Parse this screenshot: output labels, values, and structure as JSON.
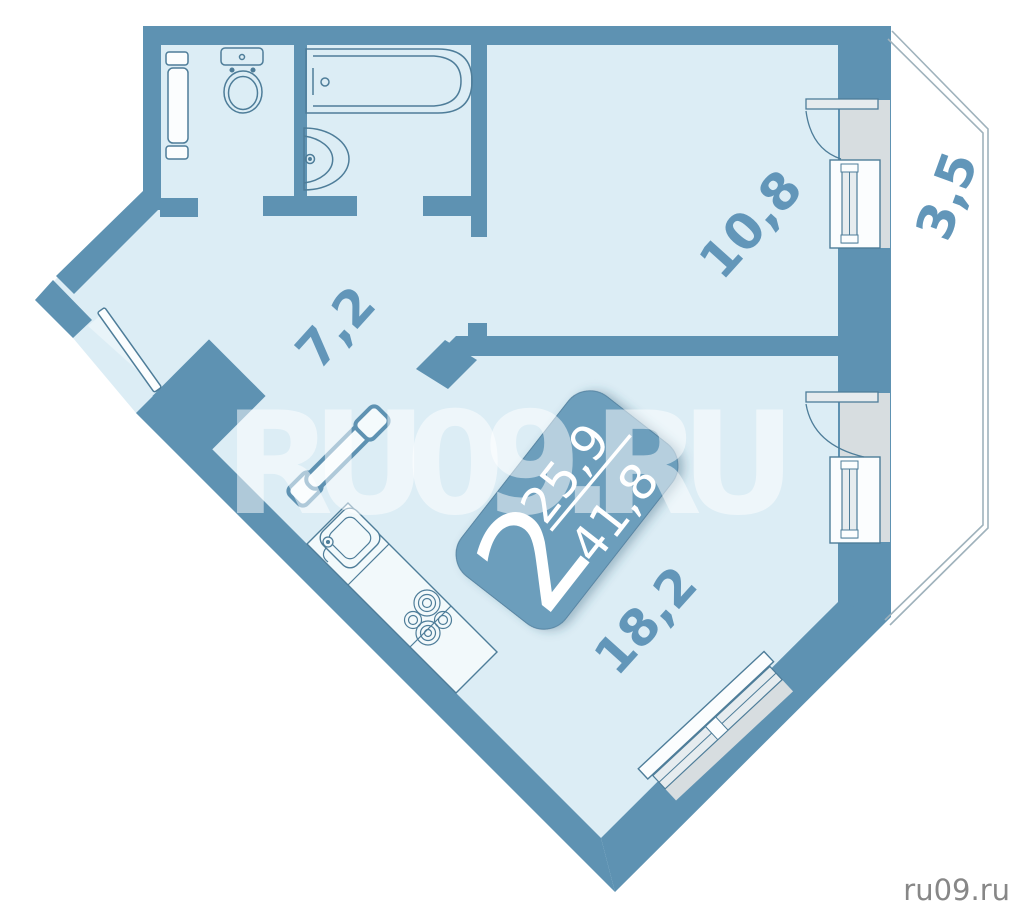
{
  "floor_plan": {
    "kind": "apartment plan, 2-room",
    "badge": {
      "rooms_count": "2",
      "living_area": "25,9",
      "total_area": "41,8"
    },
    "room_labels": [
      {
        "id": "hall",
        "area": "7,2"
      },
      {
        "id": "bedroom",
        "area": "10,8"
      },
      {
        "id": "kitchen-living",
        "area": "18,2"
      },
      {
        "id": "balcony",
        "area": "3,5"
      }
    ],
    "watermark": "RU09.RU",
    "site_logo": "ru09.ru",
    "colors": {
      "wall": "#5E92B2",
      "interior": "#DCEDF5",
      "badge": "#6C9EBC",
      "label_text": "#6296B9",
      "window_recess": "#D7DDE0",
      "fixture_line": "#4E7D99",
      "balcony_line": "#9FB2BC",
      "logo_text": "#878787",
      "watermark_fill": "#FFFFFF"
    }
  }
}
